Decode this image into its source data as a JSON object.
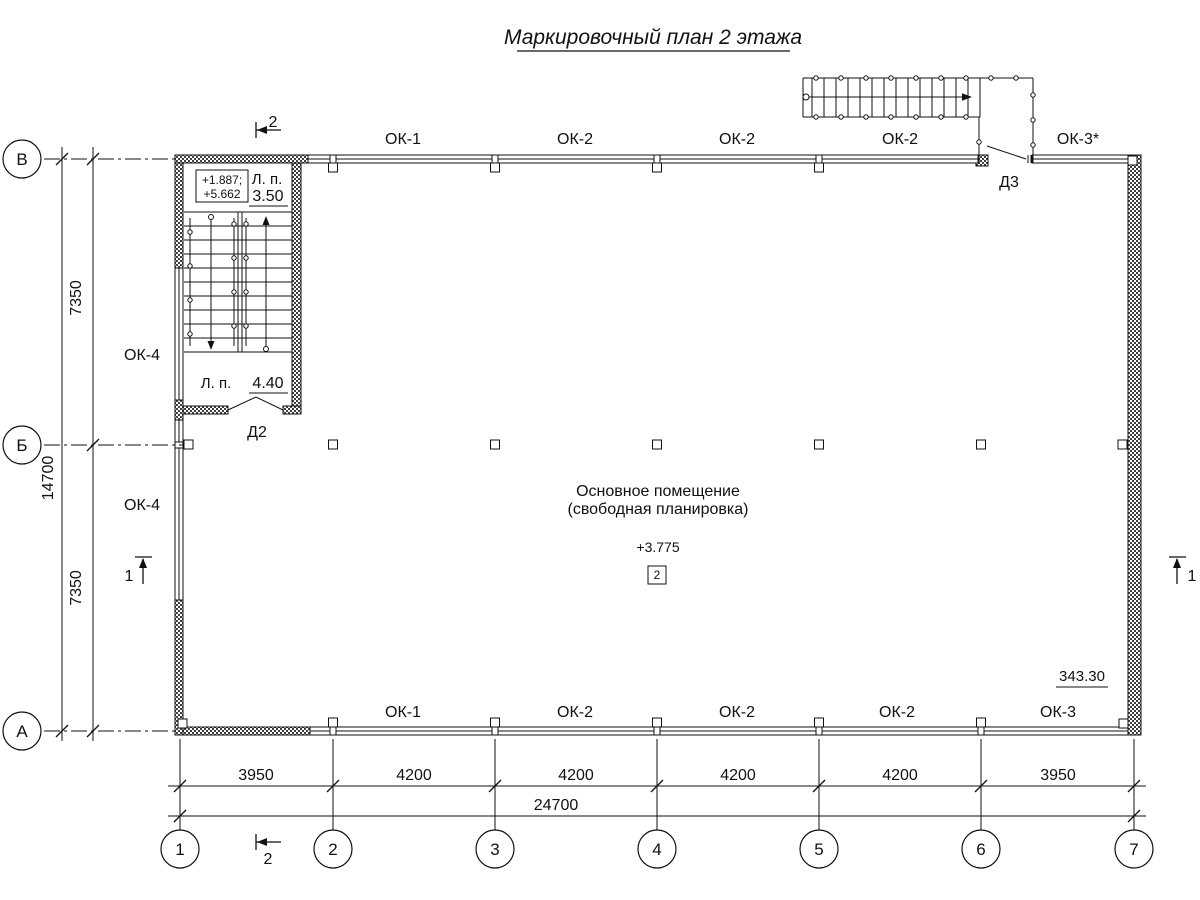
{
  "title": "Маркировочный план 2 этажа",
  "room": {
    "name1": "Основное помещение",
    "name2": "(свободная планировка)",
    "level": "+3.775",
    "num": "2",
    "area": "343.30"
  },
  "stair": {
    "elev1": "+1.887;",
    "elev2": "+5.662",
    "lp": "Л. п.",
    "upper_val": "3.50",
    "lower_val": "4.40"
  },
  "doors": {
    "d2": "Д2",
    "d3": "Д3"
  },
  "windows": {
    "top": [
      "ОК-1",
      "ОК-2",
      "ОК-2",
      "ОК-2",
      "ОК-3*"
    ],
    "bottom": [
      "ОК-1",
      "ОК-2",
      "ОК-2",
      "ОК-2",
      "ОК-3"
    ],
    "left": [
      "ОК-4",
      "ОК-4"
    ]
  },
  "grid": {
    "columns": [
      "1",
      "2",
      "3",
      "4",
      "5",
      "6",
      "7"
    ],
    "rows": [
      "В",
      "Б",
      "А"
    ]
  },
  "dims": {
    "bottom": [
      "3950",
      "4200",
      "4200",
      "4200",
      "4200",
      "3950"
    ],
    "bottom_total": "24700",
    "left": [
      "7350",
      "7350"
    ],
    "left_total": "14700"
  },
  "sections": {
    "cut1": "1",
    "cut2": "2"
  }
}
